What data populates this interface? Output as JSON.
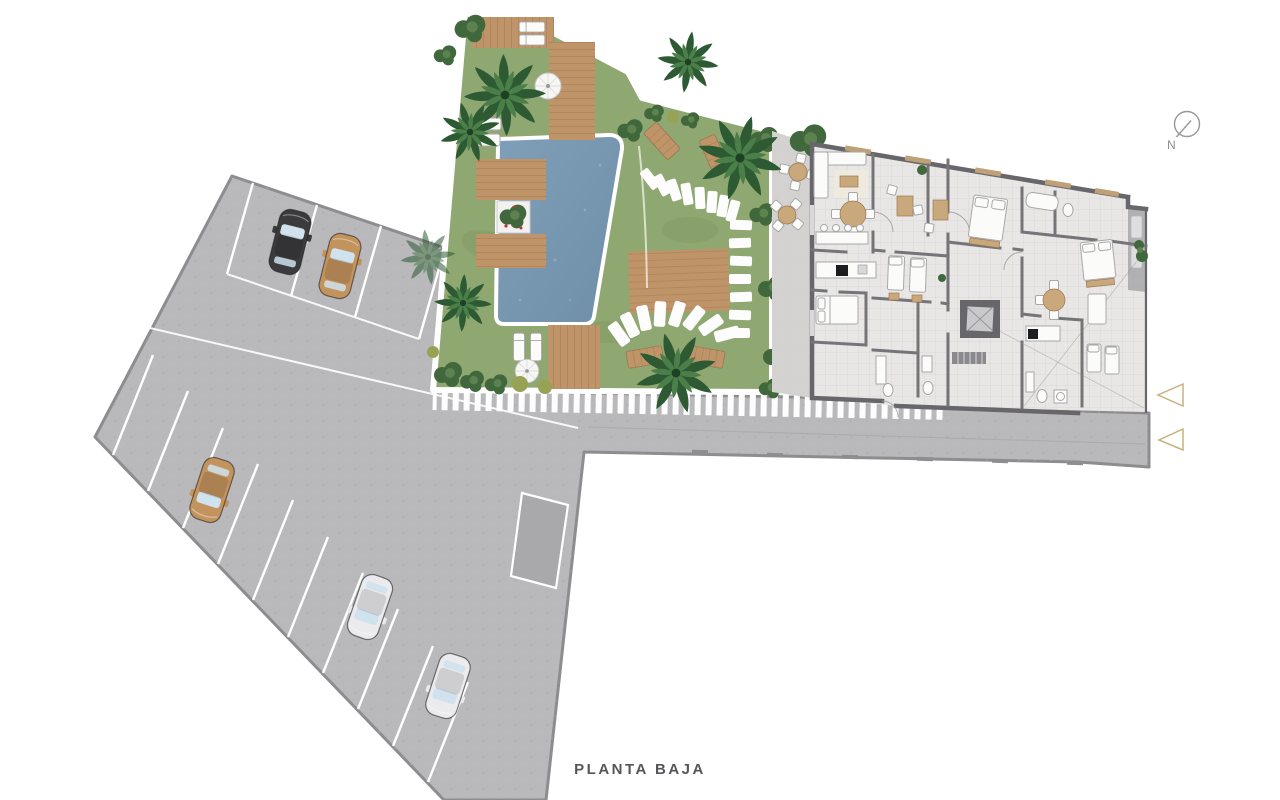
{
  "page": {
    "title": "PLANTA BAJA"
  },
  "compass": {
    "label": "N"
  },
  "colors": {
    "background": "#ffffff",
    "text": "#55565a",
    "paving": "#b9b8ba",
    "paving_border": "#8d8c8f",
    "paving_dark": "#a9a8ab",
    "stall_line": "#ffffff",
    "grass": "#8fa770",
    "grass_dark": "#7b9760",
    "bush": "#41683c",
    "bush_light": "#5d8250",
    "bush_yellow": "#97a254",
    "palm": "#2d5a33",
    "palm_light": "#4b7f4a",
    "pool_water": "#7f9eb8",
    "pool_water_deep": "#6f8fa9",
    "pool_rim": "#ffffff",
    "wood": "#bf9468",
    "wood_dark": "#9e7750",
    "floor": "#e8e7e5",
    "floor_line": "#d7d6d4",
    "patio": "#d3d2d0",
    "wall": "#67666b",
    "partition": "#757479",
    "furniture_white": "#fbfbfa",
    "furniture_stroke": "#a8a7aa",
    "accent_tan": "#c9a97b",
    "window_glass": "#cfe2ed",
    "car_black": "#3b3b3d",
    "car_tan": "#c3935d",
    "car_white": "#ebebed",
    "gold": "#c8b07e",
    "compass_stroke": "#97969a"
  }
}
